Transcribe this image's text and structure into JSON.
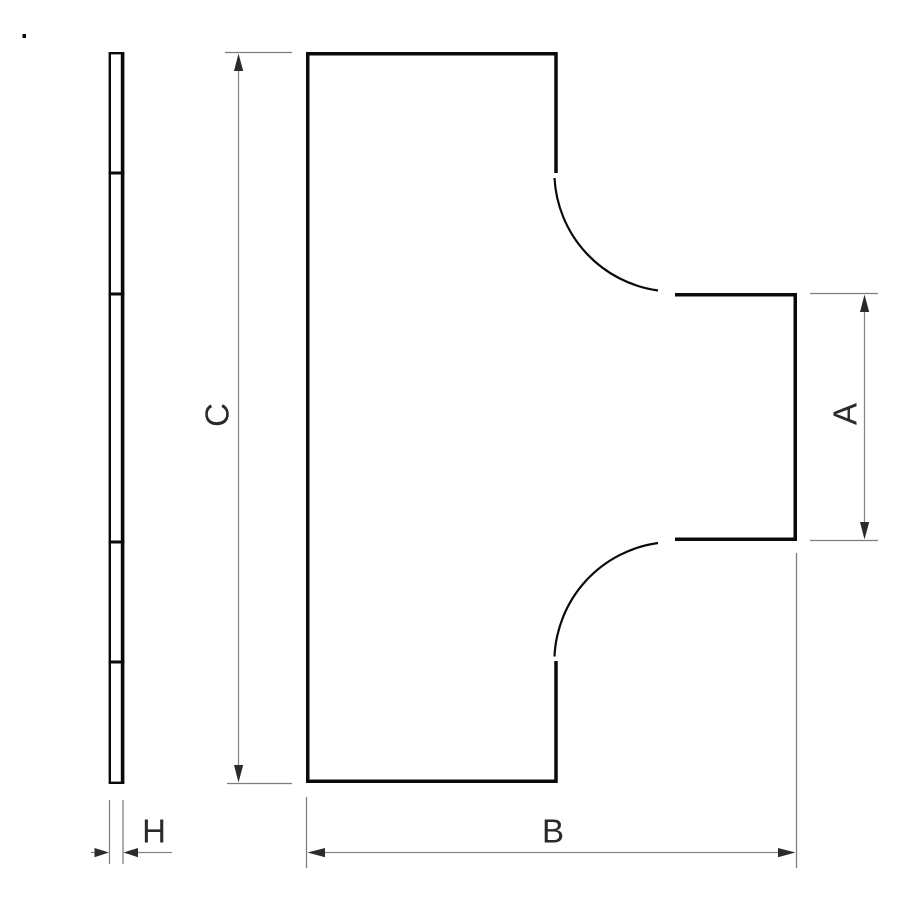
{
  "drawing": {
    "kind": "technical-dimension-drawing",
    "subject": "tee-shaped flat cover plate, edge view and plan view",
    "dimensions": {
      "branch_width": {
        "label": "A"
      },
      "overall_width": {
        "label": "B"
      },
      "overall_height": {
        "label": "C"
      },
      "thickness": {
        "label": "H"
      }
    },
    "colors": {
      "background": "#ffffff",
      "outline": "#0a0a0a",
      "dimension_line": "#848484",
      "extension_line": "#7d7d7d",
      "arrowhead": "#2b2b2b",
      "label_text": "#2a2a2a"
    }
  }
}
